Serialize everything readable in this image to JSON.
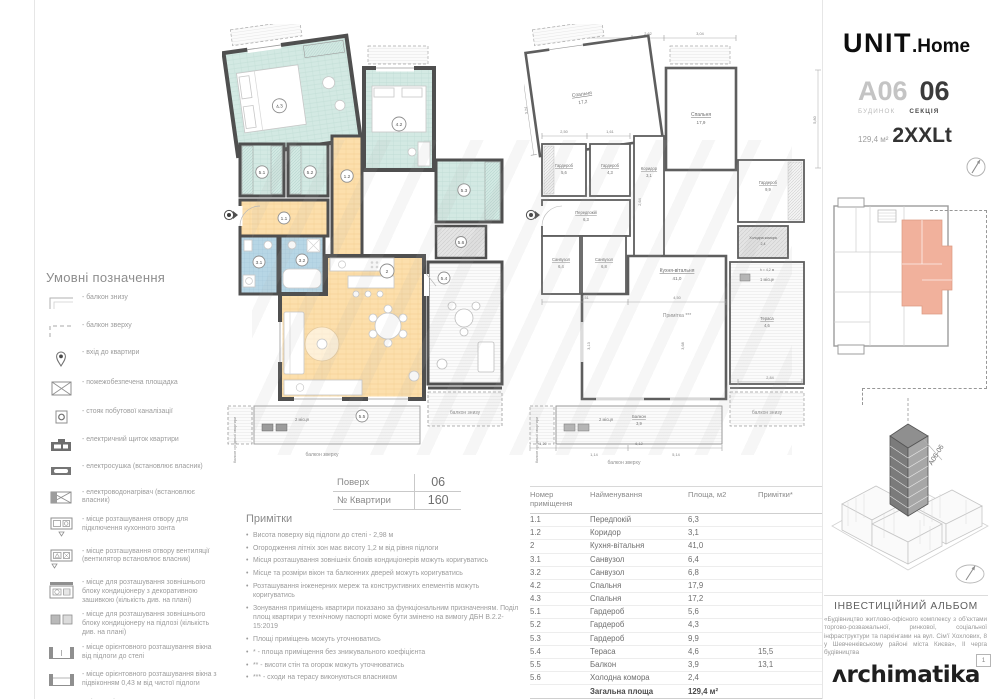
{
  "header": {
    "logo_unit": "UNIT",
    "logo_home": ".Home",
    "building_code": "A06",
    "building_label": "БУДИНОК",
    "section_code": "06",
    "section_label": "СЕКЦІЯ",
    "area_label": "129,4 м²",
    "plan_type": "2XXLt"
  },
  "legend": {
    "title": "Умовні позначення",
    "items": [
      "- балкон знизу",
      "- балкон зверху",
      "- вхід до квартири",
      "- пожежобезпечена площадка",
      "- стояк побутової каналізації",
      "- електричний щиток квартири",
      "- електросушка (встановлює власник)",
      "- електроводонагрівач (встановлює власник)",
      "- місце розташування отвору для підключення кухонного зонта",
      "- місце розташування отвору вентиляції (вентилятор встановлює власник)",
      "- місце для розташування зовнішнього блоку кондиціонеру з декоративною зашивкою (кількість див. на плані)",
      "- місце для розташування зовнішнього блоку кондиціонеру на підлозі (кількість див. на плані)",
      "- місце орієнтовного розташування вікна від підлоги до стелі",
      "- місце орієнтовного розташування вікна з підвіконням 0,43 м від чистої підлоги",
      "- місце орієнтовного розташування виходу на балкон з порогом"
    ]
  },
  "floor_info": {
    "floor_label": "Поверх",
    "floor_value": "06",
    "apt_label": "№ Квартири",
    "apt_value": "160"
  },
  "notes": {
    "title": "Примітки",
    "items": [
      "Висота поверху від підлоги до стелі - 2,98 м",
      "Огородження літніх зон має висоту 1,2 м від рівня підлоги",
      "Місця розташування зовнішніх блоків кондиціонерів можуть коригуватись",
      "Місце та розміри вікон та балконних дверей можуть коригуватись",
      "Розташування інженерних мереж та конструктивних елементів можуть коригуватись",
      "Зонування приміщень квартири показано за функціональним призначенням. Поділ площ квартири у технічному паспорті може бути змінено на вимогу ДБН В.2.2-15:2019",
      "Площі приміщень можуть уточнюватись",
      "* - площа приміщення без знижувального коефіцієнта",
      "** - висоти стін та огорож можуть уточнюватись",
      "*** - сходи на терасу виконуються власником"
    ]
  },
  "rooms_table": {
    "header_number_1": "Номер",
    "header_number_2": "приміщення",
    "header_name": "Найменування",
    "header_area": "Площа, м2",
    "header_notes": "Примітки*",
    "rows": [
      {
        "num": "1.1",
        "name": "Передпокій",
        "area": "6,3",
        "note": ""
      },
      {
        "num": "1.2",
        "name": "Коридор",
        "area": "3,1",
        "note": ""
      },
      {
        "num": "2",
        "name": "Кухня-вітальня",
        "area": "41,0",
        "note": ""
      },
      {
        "num": "3.1",
        "name": "Санвузол",
        "area": "6,4",
        "note": ""
      },
      {
        "num": "3.2",
        "name": "Санвузол",
        "area": "6,8",
        "note": ""
      },
      {
        "num": "4.2",
        "name": "Спальня",
        "area": "17,9",
        "note": ""
      },
      {
        "num": "4.3",
        "name": "Спальня",
        "area": "17,2",
        "note": ""
      },
      {
        "num": "5.1",
        "name": "Гардероб",
        "area": "5,6",
        "note": ""
      },
      {
        "num": "5.2",
        "name": "Гардероб",
        "area": "4,3",
        "note": ""
      },
      {
        "num": "5.3",
        "name": "Гардероб",
        "area": "9,9",
        "note": ""
      },
      {
        "num": "5.4",
        "name": "Тераса",
        "area": "4,6",
        "note": "15,5"
      },
      {
        "num": "5.5",
        "name": "Балкон",
        "area": "3,9",
        "note": "13,1"
      },
      {
        "num": "5.6",
        "name": "Холодна комора",
        "area": "2,4",
        "note": ""
      }
    ],
    "total_label": "Загальна площа",
    "total_value": "129,4 м²",
    "living_label": "Житлова площа",
    "living_value": "35,1 м²"
  },
  "plan_left": {
    "numbers": {
      "n11": "1.1",
      "n12": "1.2",
      "n2": "2",
      "n31": "3.1",
      "n32": "3.2",
      "n42": "4.2",
      "n43": "4.3",
      "n51": "5.1",
      "n52": "5.2",
      "n53": "5.3",
      "n54": "5.4",
      "n55": "5.5",
      "n56": "5.6"
    },
    "two_places": "2 місця",
    "balcony_top_label": "балкон зверху",
    "balcony_bottom_label": "балкон знизу",
    "neighbor_balcony_label": "балкон сусідньої квартири"
  },
  "plan_right": {
    "rooms": {
      "bedroom1_name": "Спальня",
      "bedroom1_area": "17,2",
      "bedroom2_name": "Спальня",
      "bedroom2_area": "17,9",
      "ward1_name": "Гардероб",
      "ward1_area": "5,6",
      "ward2_name": "Гардероб",
      "ward2_area": "4,3",
      "corridor_name": "Коридор",
      "corridor_area": "3,1",
      "ward3_name": "Гардероб",
      "ward3_area": "9,9",
      "bath1_name": "Санвузол",
      "bath1_area": "6,4",
      "bath2_name": "Санвузол",
      "bath2_area": "6,8",
      "hall_name": "Передпокій",
      "hall_area": "6,3",
      "kitchen_name": "Кухня-вітальня",
      "kitchen_area": "41,0",
      "terrace_name": "Тераса",
      "terrace_area": "4,6",
      "balcony_name": "Балкон",
      "balcony_area": "3,9",
      "cold_name": "Холодна комора",
      "cold_area": "2,4"
    },
    "note_ref": "Примітка ***",
    "one_place": "1 місце",
    "two_places": "2 місця",
    "height_note": "h = 4,2 м",
    "balcony_top_label": "балкон зверху",
    "balcony_bottom_label": "балкон знизу",
    "neighbor_balcony_label": "балкон сусідньої квартири",
    "dims": [
      "3,31",
      "2,62",
      "3,04",
      "3,24",
      "2,50",
      "1,61",
      "2,64",
      "1,59",
      "2,51",
      "4,50",
      "6,12",
      "1,20",
      "2,84",
      "5,80",
      "3,13",
      "3,68",
      "1,14",
      "5,14"
    ]
  },
  "album": {
    "title": "ІНВЕСТИЦІЙНИЙ АЛЬБОМ",
    "description": "«Будівництво житлово-офісного комплексу з об'єктами торгово-розважальної, ринкової, соціальної інфраструктури та паркінгами на вул. Сім'ї Хохлових, 8 у Шевченківському районі міста Києва», ІІ черга будівництва",
    "page_number": "1",
    "brand": "ʌrchimatika"
  },
  "axon_label": "A06-06"
}
